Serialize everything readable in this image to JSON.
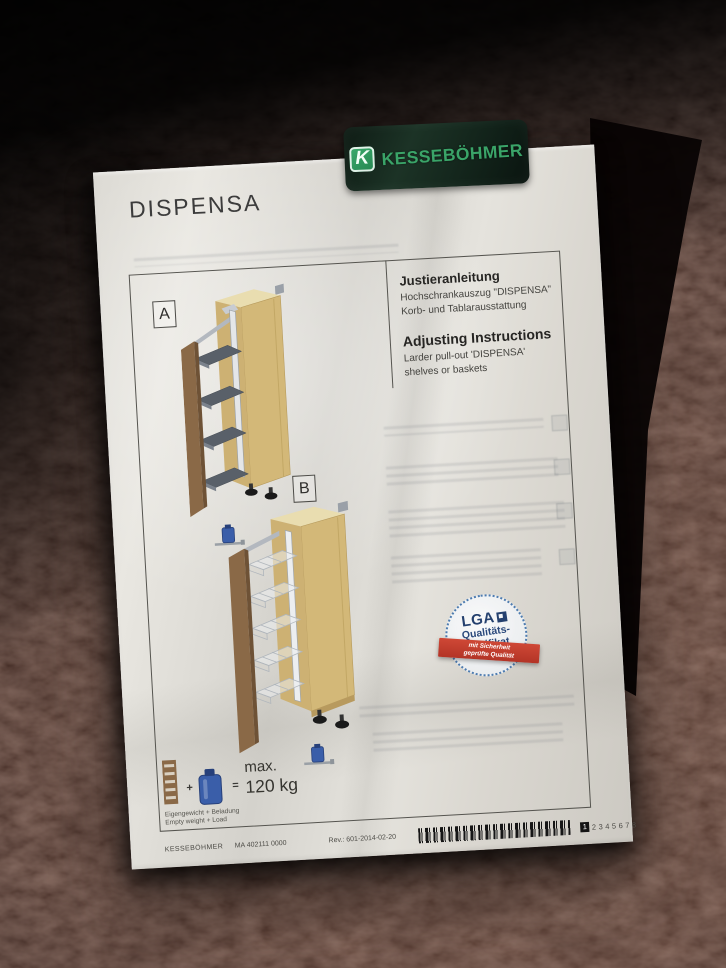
{
  "page": {
    "title": "DISPENSA",
    "logo": {
      "brand": "KESSEBÖHMER",
      "monogram": "K"
    },
    "instructions": {
      "de": {
        "heading": "Justieranleitung",
        "line1": "Hochschrankauszug \"DISPENSA\"",
        "line2": "Korb- und Tablarausstattung"
      },
      "en": {
        "heading": "Adjusting Instructions",
        "line1": "Larder pull-out 'DISPENSA'",
        "line2": "shelves or baskets"
      }
    },
    "figures": {
      "a_label": "A",
      "b_label": "B"
    },
    "badge": {
      "brand": "LGA",
      "line1": "Qualitäts-",
      "line2": "Zertifikat",
      "ribbon1": "mit Sicherheit",
      "ribbon2": "geprüfte Qualität"
    },
    "load": {
      "plus": "+",
      "equals": "=",
      "max_label": "max.",
      "value": "120 kg",
      "caption_de": "Eigengewicht + Beladung",
      "caption_en": "Empty weight + Load"
    },
    "footer": {
      "brand": "KESSEBÖHMER",
      "doc_no": "MA 402111 0000",
      "rev": "Rev.: 601-2014-02-20",
      "pages": [
        "1",
        "2",
        "3",
        "4",
        "5",
        "6",
        "7",
        "8"
      ],
      "current_page": "1"
    }
  },
  "colors": {
    "sticker_bg": "#14241b",
    "brand_green": "#3aa468",
    "paper": "#e2e0da",
    "leather": "#462b21",
    "wood_top": "#e9ddb0",
    "wood_side": "#d3b878",
    "wood_back": "#cdb173",
    "door_brown": "#8a6947",
    "door_edge": "#6e5236",
    "shelf_gray": "#596069",
    "rail_gray": "#b3b8bf",
    "canister_blue": "#3a5ea9",
    "canister_cap": "#27407a",
    "badge_blue": "#2c4a7c",
    "ribbon_red": "#c23f2f",
    "feet_black": "#1a1a1a"
  }
}
